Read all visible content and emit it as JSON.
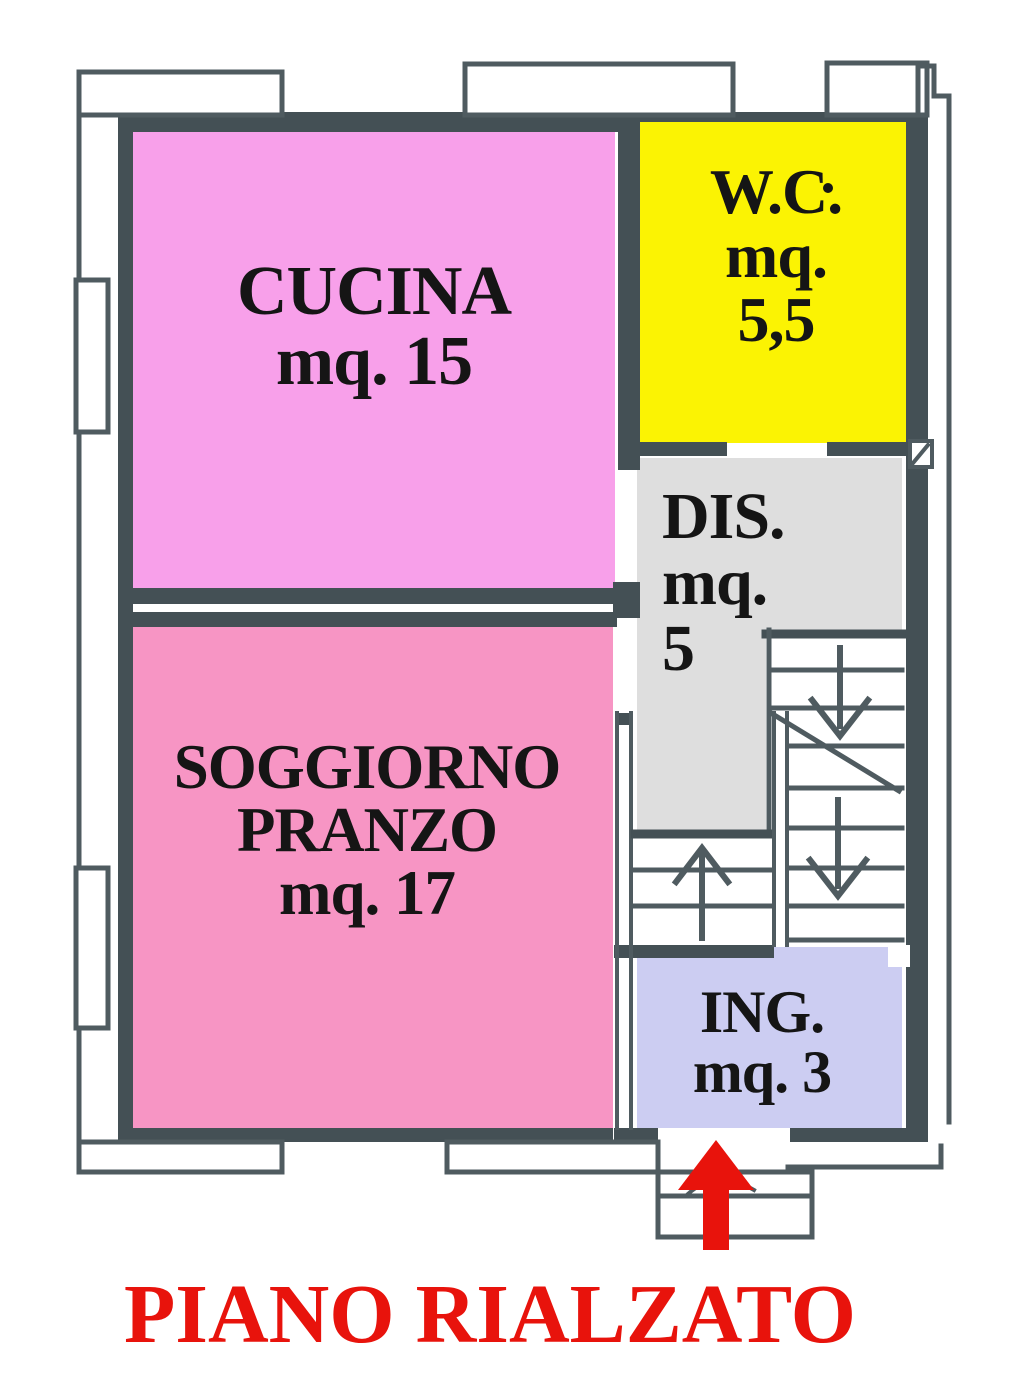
{
  "plan": {
    "title": "PIANO RIALZATO",
    "rooms": [
      {
        "key": "cucina",
        "lines": [
          "CUCINA",
          "mq. 15"
        ],
        "color": "#f8a0ea"
      },
      {
        "key": "wc",
        "lines": [
          "W.C.",
          "mq.",
          "5,5"
        ],
        "color": "#fbf303"
      },
      {
        "key": "dis",
        "lines": [
          "DIS.",
          "mq.",
          "5"
        ],
        "color": "#dedede"
      },
      {
        "key": "soggiorno",
        "lines": [
          "SOGGIORNO",
          "PRANZO",
          "mq. 17"
        ],
        "color": "#f795c4"
      },
      {
        "key": "ing",
        "lines": [
          "ING.",
          "mq. 3"
        ],
        "color": "#cccdf2"
      }
    ],
    "symbols": {
      "entrance_arrow": "red arrow pointing up into entrance",
      "stair_left_flight_arrow": "up",
      "stair_right_flight_arrows": "down",
      "shaft_symbol": "hatched square"
    }
  },
  "colors": {
    "wall": "#445055",
    "line": "#4f5b60",
    "accent_red": "#e8130c",
    "text": "#151515",
    "paper": "#ffffff"
  }
}
